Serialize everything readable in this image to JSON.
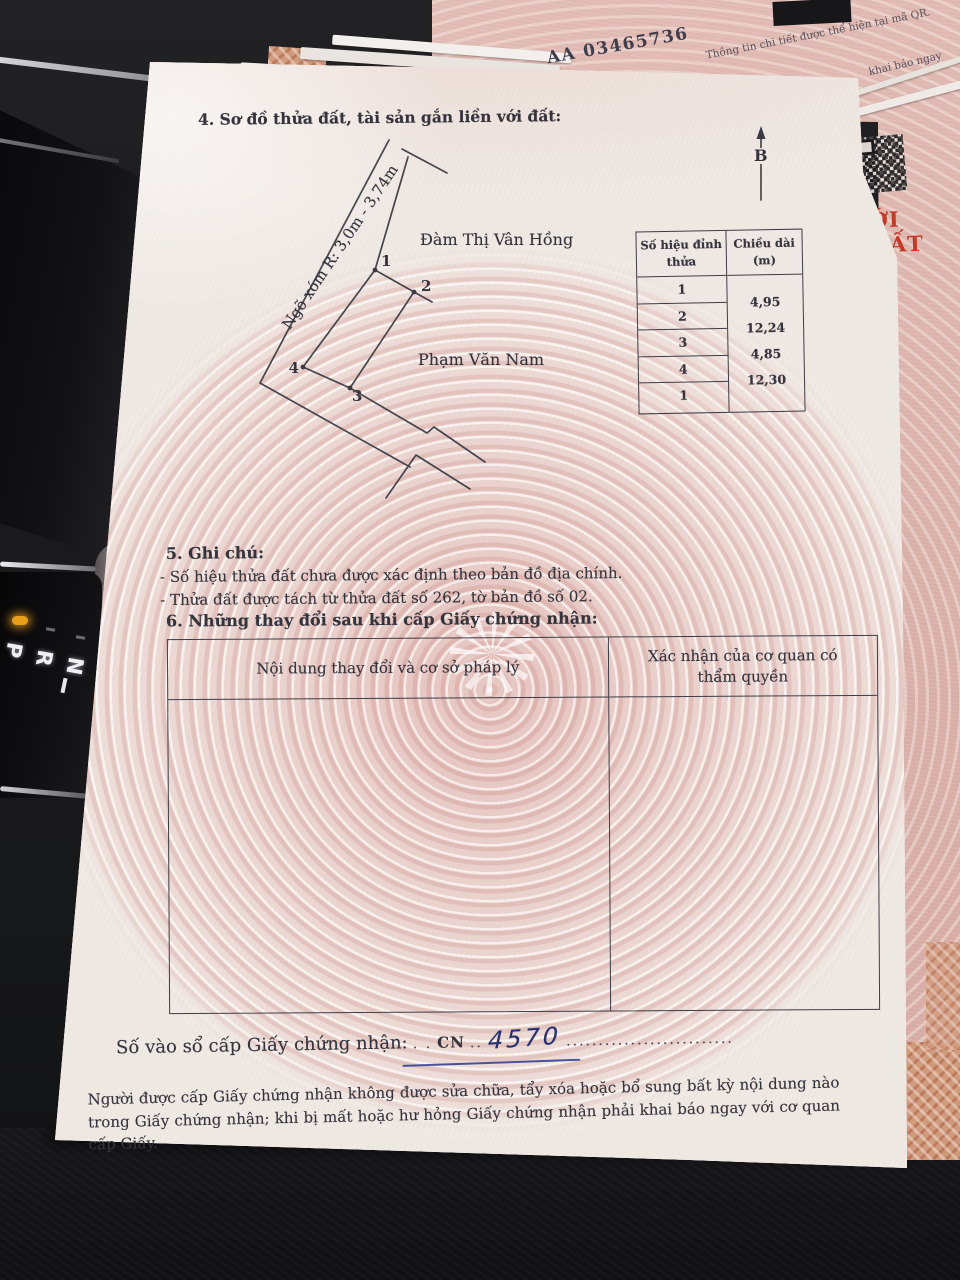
{
  "scene": {
    "background_serial": "AA 03465736",
    "qr_note": "Thông tin chi tiết được thể hiện tại mã QR.",
    "back_sheet_fragment": "khai báo ngay",
    "red_title_fragment": "ỚI ĐẤT",
    "gear_selector": {
      "labels": [
        "P",
        "R",
        "N"
      ]
    }
  },
  "document": {
    "section4_title": "4. Sơ đồ thửa đất, tài sản gắn liền với đất:",
    "compass_label": "B",
    "diagram": {
      "road_label": "Ngõ xóm R: 3,0m - 3,74m",
      "neighbor_top": "Đàm Thị Vân Hồng",
      "neighbor_bottom": "Phạm Văn Nam",
      "vertex_labels": [
        "1",
        "2",
        "3",
        "4"
      ]
    },
    "vertex_table": {
      "col1_header": "Số hiệu đỉnh thửa",
      "col2_header": "Chiều dài (m)",
      "vertices": [
        "1",
        "2",
        "3",
        "4",
        "1"
      ],
      "lengths": [
        "4,95",
        "12,24",
        "4,85",
        "12,30"
      ]
    },
    "section5_title": "5. Ghi chú:",
    "section5_notes": [
      "- Số hiệu thửa đất chưa được xác định theo bản đồ địa chính.",
      "- Thửa đất được tách từ thửa đất số 262, tờ bản đồ số 02."
    ],
    "section6_title": "6. Những thay đổi sau khi cấp Giấy chứng nhận:",
    "section6_col1": "Nội dung thay đổi và cơ sở pháp lý",
    "section6_col2": "Xác nhận của cơ quan có thẩm quyền",
    "registry_label": "Số vào sổ cấp Giấy chứng nhận:",
    "registry_predots": ". .",
    "registry_prefix": "CN",
    "registry_middots": "..",
    "registry_number": "4570",
    "registry_dots": "..........................",
    "footer_note": "Người được cấp Giấy chứng nhận không được sửa chữa, tẩy xóa hoặc bổ sung bất kỳ nội dung nào trong Giấy chứng nhận; khi bị mất hoặc hư hỏng Giấy chứng nhận phải khai báo ngay với cơ quan cấp Giấy."
  },
  "colors": {
    "paper": "#f0eae5",
    "pattern_pink": "#e2bdb9",
    "back_sheet": "#ddb6af",
    "red_text": "#c23a28",
    "ink": "#35343d",
    "ink_blue": "#26336f",
    "amber_indicator": "#e79f1c"
  }
}
